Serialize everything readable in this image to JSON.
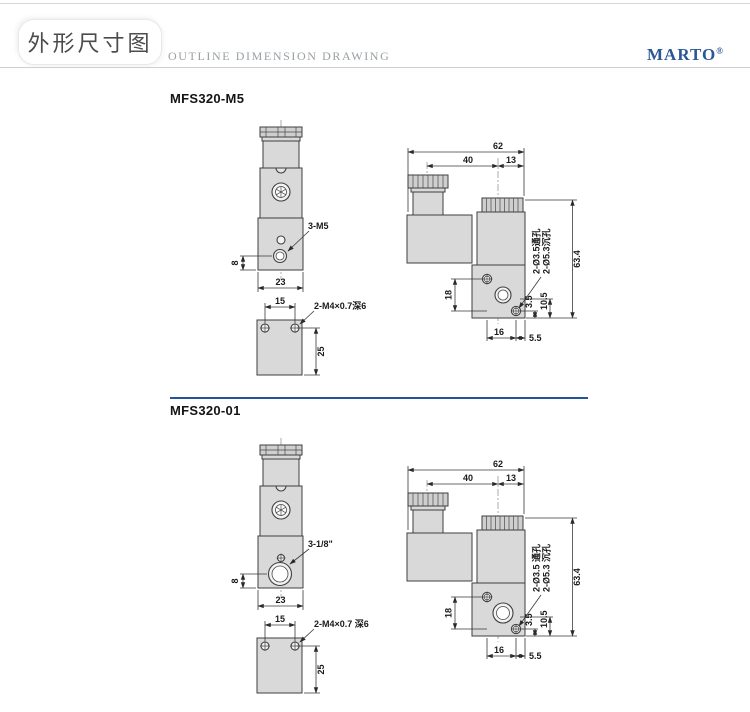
{
  "header": {
    "title_cn": "外形尺寸图",
    "title_en": "OUTLINE DIMENSION DRAWING",
    "brand": "MARTO",
    "brand_reg": "®",
    "brand_color": "#2b5797",
    "divider_color": "#24549c"
  },
  "drawing_colors": {
    "body_fill": "#d9d9d9",
    "outline": "#3f3f3f"
  },
  "sections": [
    {
      "model": "MFS320-M5",
      "front": {
        "port_label": "3-M5",
        "dim_port_to_bottom": "8",
        "dim_width": "23"
      },
      "bottom": {
        "dim_hole_spacing": "15",
        "holes_label": "2-M4×0.7深6",
        "dim_depth": "25"
      },
      "side": {
        "dim_total_width": "62",
        "dim_coil_to_center": "40",
        "dim_center_to_edge": "13",
        "note_through": "2-Ø3.5通孔",
        "note_counterbore": "2-Ø5.3沉孔",
        "dim_total_height": "63.4",
        "dim_hole_v": "18",
        "dim_3_5": "3.5",
        "dim_10_5": "10.5",
        "dim_hole_h": "16",
        "dim_edge": "5.5"
      }
    },
    {
      "model": "MFS320-01",
      "front": {
        "port_label": "3-1/8\"",
        "dim_port_to_bottom": "8",
        "dim_width": "23"
      },
      "bottom": {
        "dim_hole_spacing": "15",
        "holes_label": "2-M4×0.7 深6",
        "dim_depth": "25"
      },
      "side": {
        "dim_total_width": "62",
        "dim_coil_to_center": "40",
        "dim_center_to_edge": "13",
        "note_through": "2-Ø3.5 通孔",
        "note_counterbore": "2-Ø5.3 沉孔",
        "dim_total_height": "63.4",
        "dim_hole_v": "18",
        "dim_3_5": "3.5",
        "dim_10_5": "10.5",
        "dim_hole_h": "16",
        "dim_edge": "5.5"
      }
    }
  ]
}
